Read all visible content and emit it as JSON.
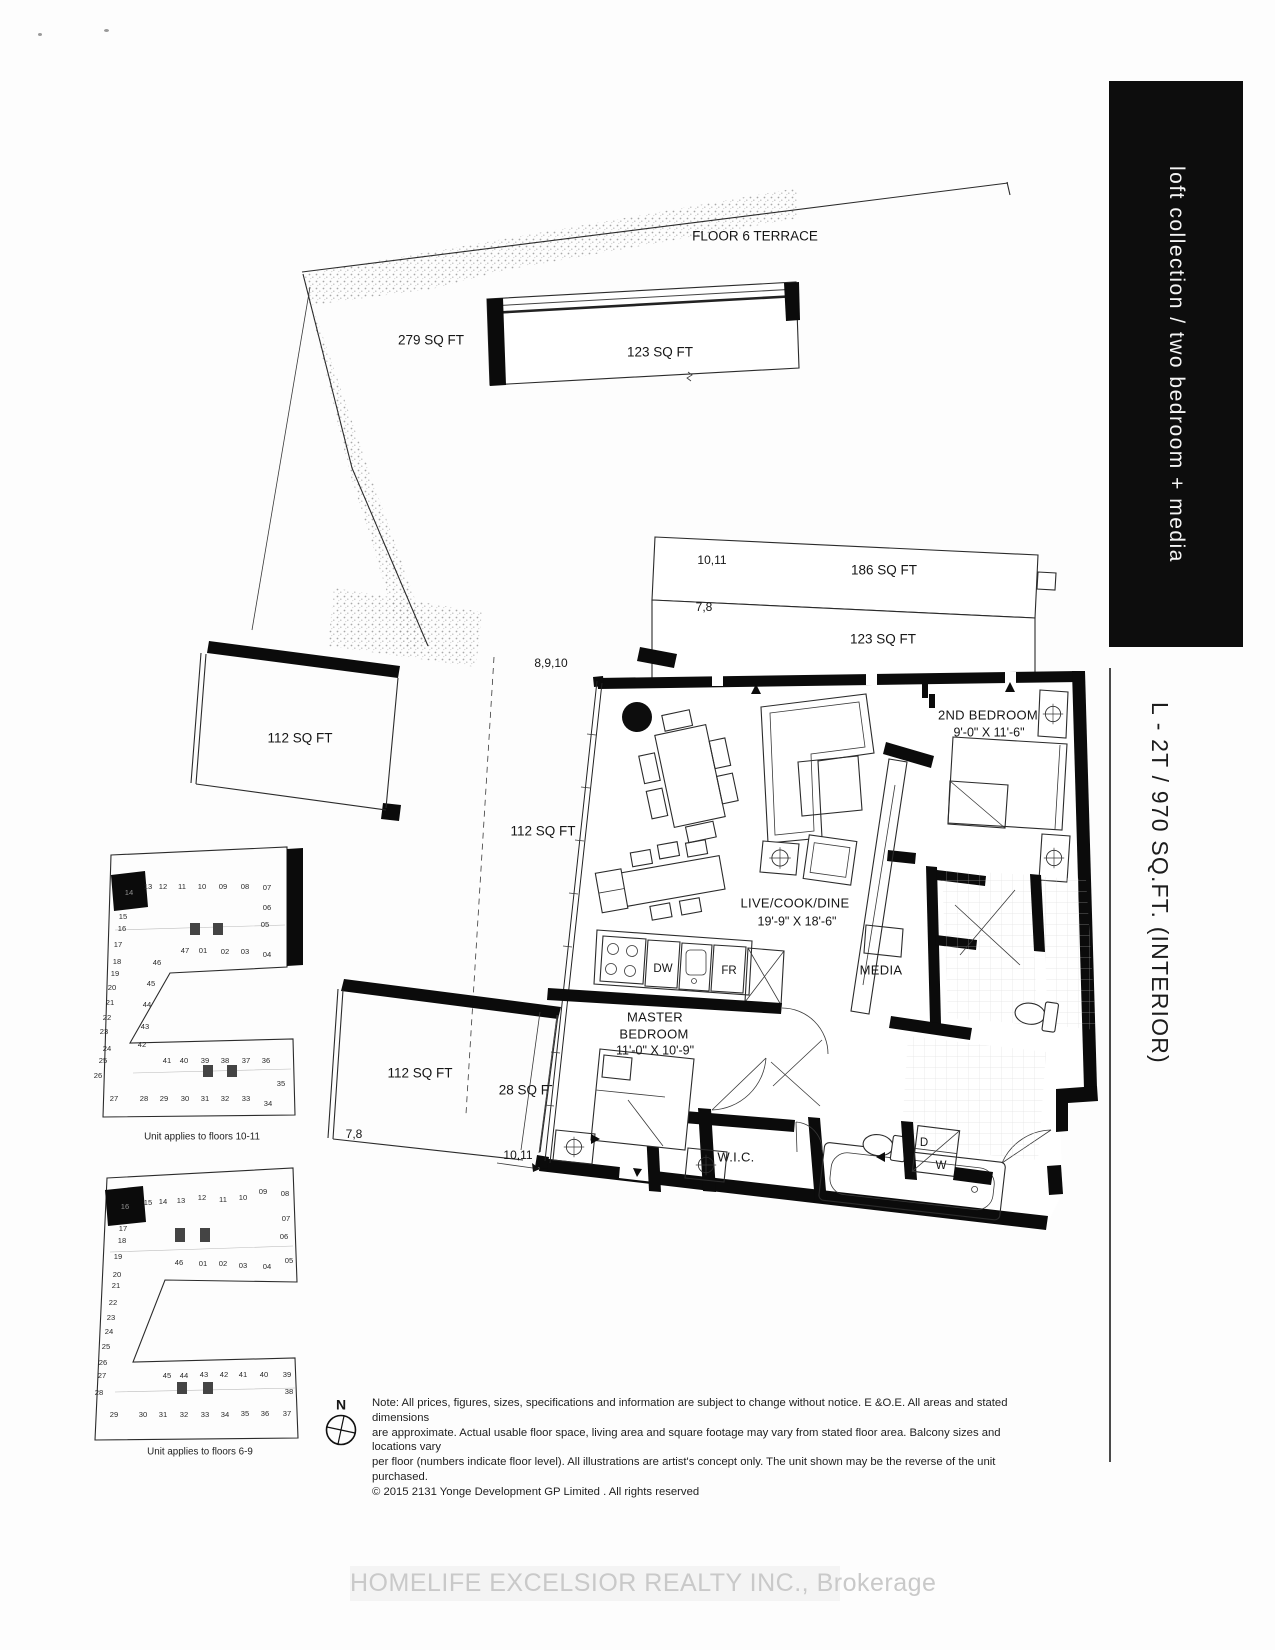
{
  "sidebar": {
    "collection": "loft collection / two bedroom + media",
    "unit_code": "L - 2T / 970 SQ.FT. (INTERIOR)"
  },
  "plan": {
    "floor6_terrace": "FLOOR 6 TERRACE",
    "terrace_279": "279 SQ FT",
    "balcony_123_top": "123 SQ FT",
    "balcony_186": {
      "floors": "10,11",
      "area": "186 SQ FT"
    },
    "balcony_123": {
      "floors": "7,8",
      "area": "123 SQ FT"
    },
    "terrace_112_upper": "112 SQ FT",
    "strip_112": {
      "floors": "8,9,10",
      "area": "112 SQ FT"
    },
    "terrace_112_lower": {
      "area": "112 SQ FT",
      "floors": "7,8"
    },
    "strip_28": {
      "area": "28 SQ FT",
      "floors": "10,11"
    },
    "rooms": {
      "live_cook_dine": {
        "name": "LIVE/COOK/DINE",
        "dims": "19'-9\" X 18'-6\""
      },
      "second_bedroom": {
        "name": "2ND BEDROOM",
        "dims": "9'-0\" X 11'-6\""
      },
      "master_bedroom": {
        "name_line1": "MASTER",
        "name_line2": "BEDROOM",
        "dims": "11'-0\" X 10'-9\""
      },
      "media": "MEDIA",
      "wic": "W.I.C."
    },
    "appliances": {
      "dishwasher": "DW",
      "fridge": "FR",
      "dryer": "D",
      "washer": "W"
    }
  },
  "keyplans": {
    "upper": {
      "caption": "Unit applies to floors 10-11",
      "highlighted_unit": "14",
      "units": [
        {
          "n": "14",
          "x": 54,
          "y": 78,
          "hl": true
        },
        {
          "n": "13",
          "x": 73,
          "y": 72
        },
        {
          "n": "12",
          "x": 88,
          "y": 72
        },
        {
          "n": "11",
          "x": 107,
          "y": 72
        },
        {
          "n": "10",
          "x": 127,
          "y": 72
        },
        {
          "n": "09",
          "x": 148,
          "y": 72
        },
        {
          "n": "08",
          "x": 170,
          "y": 72
        },
        {
          "n": "07",
          "x": 192,
          "y": 73
        },
        {
          "n": "06",
          "x": 192,
          "y": 93
        },
        {
          "n": "05",
          "x": 190,
          "y": 110
        },
        {
          "n": "47",
          "x": 110,
          "y": 136
        },
        {
          "n": "01",
          "x": 128,
          "y": 136
        },
        {
          "n": "02",
          "x": 150,
          "y": 137
        },
        {
          "n": "03",
          "x": 170,
          "y": 137
        },
        {
          "n": "04",
          "x": 192,
          "y": 140
        },
        {
          "n": "46",
          "x": 82,
          "y": 148
        },
        {
          "n": "45",
          "x": 76,
          "y": 169
        },
        {
          "n": "44",
          "x": 72,
          "y": 190
        },
        {
          "n": "43",
          "x": 70,
          "y": 212
        },
        {
          "n": "42",
          "x": 67,
          "y": 230
        },
        {
          "n": "15",
          "x": 48,
          "y": 102
        },
        {
          "n": "16",
          "x": 47,
          "y": 114
        },
        {
          "n": "17",
          "x": 43,
          "y": 130
        },
        {
          "n": "18",
          "x": 42,
          "y": 147
        },
        {
          "n": "19",
          "x": 40,
          "y": 159
        },
        {
          "n": "20",
          "x": 37,
          "y": 173
        },
        {
          "n": "21",
          "x": 35,
          "y": 188
        },
        {
          "n": "22",
          "x": 32,
          "y": 203
        },
        {
          "n": "23",
          "x": 29,
          "y": 217
        },
        {
          "n": "24",
          "x": 32,
          "y": 234
        },
        {
          "n": "25",
          "x": 28,
          "y": 246
        },
        {
          "n": "26",
          "x": 23,
          "y": 261
        },
        {
          "n": "27",
          "x": 39,
          "y": 284
        },
        {
          "n": "28",
          "x": 69,
          "y": 284
        },
        {
          "n": "29",
          "x": 89,
          "y": 284
        },
        {
          "n": "30",
          "x": 110,
          "y": 284
        },
        {
          "n": "31",
          "x": 130,
          "y": 284
        },
        {
          "n": "32",
          "x": 150,
          "y": 284
        },
        {
          "n": "33",
          "x": 171,
          "y": 284
        },
        {
          "n": "34",
          "x": 193,
          "y": 289
        },
        {
          "n": "35",
          "x": 206,
          "y": 269
        },
        {
          "n": "36",
          "x": 191,
          "y": 246
        },
        {
          "n": "37",
          "x": 171,
          "y": 246
        },
        {
          "n": "38",
          "x": 150,
          "y": 246
        },
        {
          "n": "39",
          "x": 130,
          "y": 246
        },
        {
          "n": "40",
          "x": 109,
          "y": 246
        },
        {
          "n": "41",
          "x": 92,
          "y": 246
        }
      ]
    },
    "lower": {
      "caption": "Unit applies to floors 6-9",
      "highlighted_unit": "16",
      "units": [
        {
          "n": "16",
          "x": 70,
          "y": 67,
          "hl": true
        },
        {
          "n": "15",
          "x": 93,
          "y": 63
        },
        {
          "n": "14",
          "x": 108,
          "y": 62
        },
        {
          "n": "13",
          "x": 126,
          "y": 61
        },
        {
          "n": "12",
          "x": 147,
          "y": 58
        },
        {
          "n": "11",
          "x": 168,
          "y": 60
        },
        {
          "n": "10",
          "x": 188,
          "y": 58
        },
        {
          "n": "09",
          "x": 208,
          "y": 52
        },
        {
          "n": "08",
          "x": 230,
          "y": 54
        },
        {
          "n": "07",
          "x": 231,
          "y": 79
        },
        {
          "n": "06",
          "x": 229,
          "y": 97
        },
        {
          "n": "05",
          "x": 234,
          "y": 121
        },
        {
          "n": "46",
          "x": 124,
          "y": 123
        },
        {
          "n": "01",
          "x": 148,
          "y": 124
        },
        {
          "n": "02",
          "x": 168,
          "y": 124
        },
        {
          "n": "03",
          "x": 188,
          "y": 126
        },
        {
          "n": "04",
          "x": 212,
          "y": 127
        },
        {
          "n": "17",
          "x": 68,
          "y": 89
        },
        {
          "n": "18",
          "x": 67,
          "y": 101
        },
        {
          "n": "19",
          "x": 63,
          "y": 117
        },
        {
          "n": "20",
          "x": 62,
          "y": 135
        },
        {
          "n": "21",
          "x": 61,
          "y": 146
        },
        {
          "n": "22",
          "x": 58,
          "y": 163
        },
        {
          "n": "23",
          "x": 56,
          "y": 178
        },
        {
          "n": "24",
          "x": 54,
          "y": 192
        },
        {
          "n": "25",
          "x": 51,
          "y": 207
        },
        {
          "n": "26",
          "x": 48,
          "y": 223
        },
        {
          "n": "27",
          "x": 47,
          "y": 236
        },
        {
          "n": "28",
          "x": 44,
          "y": 253
        },
        {
          "n": "45",
          "x": 112,
          "y": 236
        },
        {
          "n": "44",
          "x": 129,
          "y": 236
        },
        {
          "n": "43",
          "x": 149,
          "y": 235
        },
        {
          "n": "42",
          "x": 169,
          "y": 235
        },
        {
          "n": "41",
          "x": 188,
          "y": 235
        },
        {
          "n": "40",
          "x": 209,
          "y": 235
        },
        {
          "n": "39",
          "x": 232,
          "y": 235
        },
        {
          "n": "38",
          "x": 234,
          "y": 252
        },
        {
          "n": "37",
          "x": 232,
          "y": 274
        },
        {
          "n": "29",
          "x": 59,
          "y": 275
        },
        {
          "n": "30",
          "x": 88,
          "y": 275
        },
        {
          "n": "31",
          "x": 108,
          "y": 275
        },
        {
          "n": "32",
          "x": 129,
          "y": 275
        },
        {
          "n": "33",
          "x": 150,
          "y": 275
        },
        {
          "n": "34",
          "x": 170,
          "y": 275
        },
        {
          "n": "35",
          "x": 190,
          "y": 274
        },
        {
          "n": "36",
          "x": 210,
          "y": 274
        }
      ]
    }
  },
  "compass": {
    "north": "N"
  },
  "disclaimer": {
    "line1": "Note: All prices, figures, sizes, specifications and information are subject to change without notice. E &O.E. All areas and stated dimensions",
    "line2": "are approximate. Actual usable floor space, living area and square footage may vary from stated floor area. Balcony sizes and locations vary",
    "line3": "per floor (numbers indicate floor level). All illustrations are artist's concept only. The unit shown may be the reverse of the unit purchased.",
    "line4": "© 2015  2131 Yonge Development GP Limited . All rights reserved"
  },
  "watermark": "HOMELIFE EXCELSIOR REALTY INC., Brokerage"
}
